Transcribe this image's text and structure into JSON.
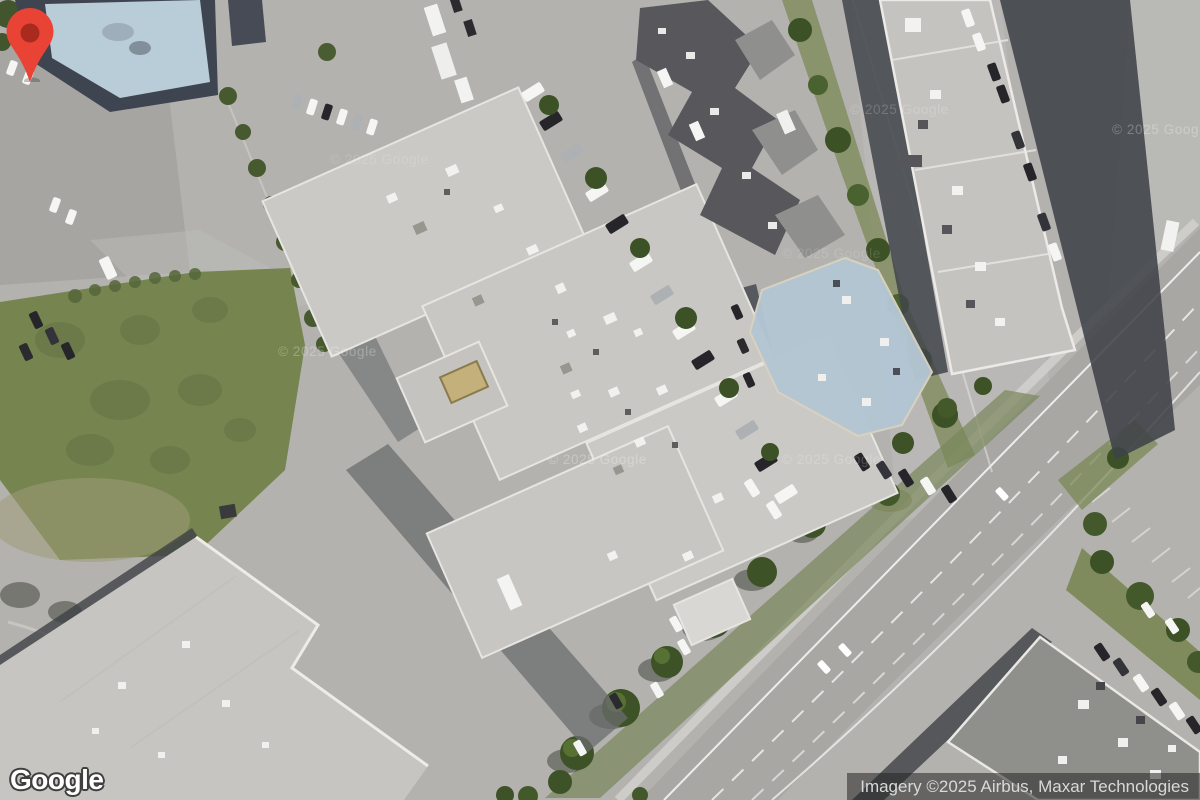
{
  "map": {
    "view_type": "satellite",
    "logo_text": "Google",
    "attribution_text": "Imagery ©2025 Airbus, Maxar Technologies",
    "watermark_text": "© 2025 Google",
    "marker_color": "#E84335",
    "marker_inner_color": "#A92B1E"
  }
}
